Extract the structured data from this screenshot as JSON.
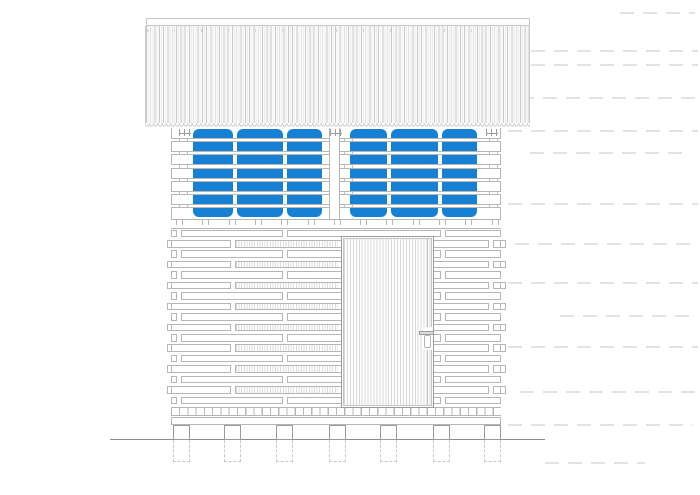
{
  "document": {
    "kind": "architectural front elevation drawing of a raised storehouse",
    "visible_text": ""
  },
  "colors": {
    "paper": "#ffffff",
    "panel_blue": "#1680d4",
    "wall_line": "#b6b6b6",
    "detail_line": "#9a9a9a",
    "roof_line": "#c9c9c9",
    "roof_faint": "#ededed",
    "hatch_line": "#dcdcdc",
    "door_plank": "#d9d9d9",
    "ground": "#8c8c8c",
    "dash": "#e3e3e3"
  },
  "roof": {
    "x": 145,
    "y": 18,
    "width": 385,
    "cap_height": 8,
    "body_height": 97,
    "wave_height": 5,
    "rib_pitch": 4.3,
    "tick_pitch": 27
  },
  "brackets": {
    "y": 128.5,
    "width": 12,
    "height": 7,
    "xs": [
      179,
      330,
      486
    ]
  },
  "window_band": {
    "x": 171,
    "y": 128,
    "width": 330,
    "height": 90.5,
    "panel_top": 129,
    "panel_height": 88,
    "panel_radius": 6,
    "panels": [
      {
        "x": 193,
        "w": 40
      },
      {
        "x": 237,
        "w": 46
      },
      {
        "x": 287,
        "w": 35
      },
      {
        "x": 350,
        "w": 37
      },
      {
        "x": 391,
        "w": 47
      },
      {
        "x": 442,
        "w": 35
      }
    ],
    "slat_first_y": 138,
    "slat_pitch": 13.17,
    "slat_height": 4.2,
    "slat_count": 6,
    "tick_xs": [
      179,
      187,
      344,
      352,
      489,
      497
    ],
    "post": {
      "x": 329,
      "w": 11
    }
  },
  "lintel": {
    "y": 218.5,
    "height": 10,
    "tick_start": 176,
    "tick_pitch": 26.3,
    "tick_width": 7,
    "tick_height": 6.5,
    "tick_count": 13
  },
  "siding": {
    "x": 171,
    "width": 330,
    "first_y": 229.5,
    "pitch": 10.45,
    "board_height": 7.6,
    "row_count": 17,
    "stagger_width": 4.5,
    "joints_even": [
      176,
      282,
      440
    ],
    "joints_odd": [
      230,
      488
    ],
    "hatch": {
      "x": 236,
      "width": 102,
      "pitch": 2.6
    }
  },
  "sill": {
    "y": 407,
    "height": 8.5,
    "square_pitch": 8.25
  },
  "base_board": {
    "y": 416.5,
    "height": 8
  },
  "door": {
    "x": 341,
    "y": 236,
    "width": 93,
    "height": 172,
    "leaf_inset": 2,
    "plank_pitch": 2.95,
    "stile_offset": 86,
    "handle": {
      "x": 419,
      "y": 330.5,
      "w": 14.5,
      "h": 4
    },
    "plate": {
      "x": 424,
      "y": 335,
      "w": 7,
      "h": 13
    }
  },
  "piers": {
    "width": 17,
    "top_y": 424.5,
    "ground_y": 439.5,
    "footing_bottom": 462,
    "xs": [
      173,
      223.5,
      276,
      329,
      379.5,
      433,
      483.5
    ]
  },
  "ground_line": {
    "x1": 110,
    "x2": 545,
    "y": 439
  },
  "margin_dashes": [
    {
      "x": 620,
      "y": 12,
      "w": 75
    },
    {
      "x": 508,
      "y": 50,
      "w": 190
    },
    {
      "x": 508,
      "y": 64,
      "w": 190
    },
    {
      "x": 520,
      "y": 97,
      "w": 175
    },
    {
      "x": 508,
      "y": 130,
      "w": 190
    },
    {
      "x": 530,
      "y": 152,
      "w": 160
    },
    {
      "x": 508,
      "y": 203,
      "w": 190
    },
    {
      "x": 515,
      "y": 243,
      "w": 180
    },
    {
      "x": 508,
      "y": 282,
      "w": 190
    },
    {
      "x": 560,
      "y": 315,
      "w": 135
    },
    {
      "x": 508,
      "y": 346,
      "w": 190
    },
    {
      "x": 520,
      "y": 391,
      "w": 175
    },
    {
      "x": 508,
      "y": 424,
      "w": 185
    },
    {
      "x": 545,
      "y": 462,
      "w": 100
    }
  ]
}
